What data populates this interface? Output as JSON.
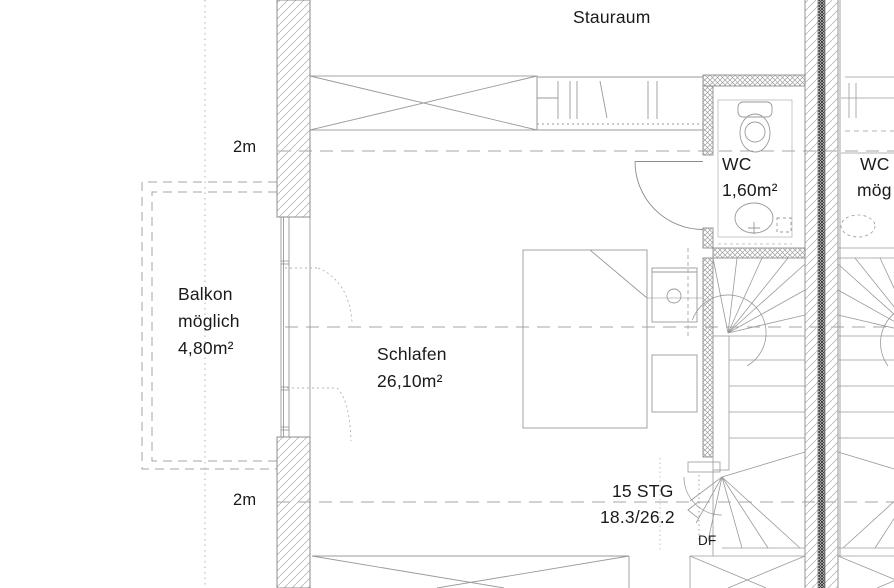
{
  "plan_type": "floorplan",
  "colors": {
    "background": "#ffffff",
    "line": "#8c8c8c",
    "furniture_line": "#9a9a9a",
    "hatch": "#b8b8b8",
    "wall_core": "#3c3c3c",
    "dashed_line": "#a6a6a6",
    "text": "#1a1a1a"
  },
  "labels": {
    "storage": "Stauraum",
    "dim_top": "2m",
    "dim_bottom": "2m",
    "balcony": {
      "name": "Balkon",
      "note": "möglich",
      "area": "4,80m²"
    },
    "bedroom": {
      "name": "Schlafen",
      "area": "26,10m²"
    },
    "wc": {
      "name": "WC",
      "area": "1,60m²"
    },
    "neighbor_wc": {
      "name": "WC",
      "note": "mög"
    },
    "stairs": {
      "count": "15 STG",
      "ratio": "18.3/26.2"
    },
    "roof_window": "DF"
  }
}
